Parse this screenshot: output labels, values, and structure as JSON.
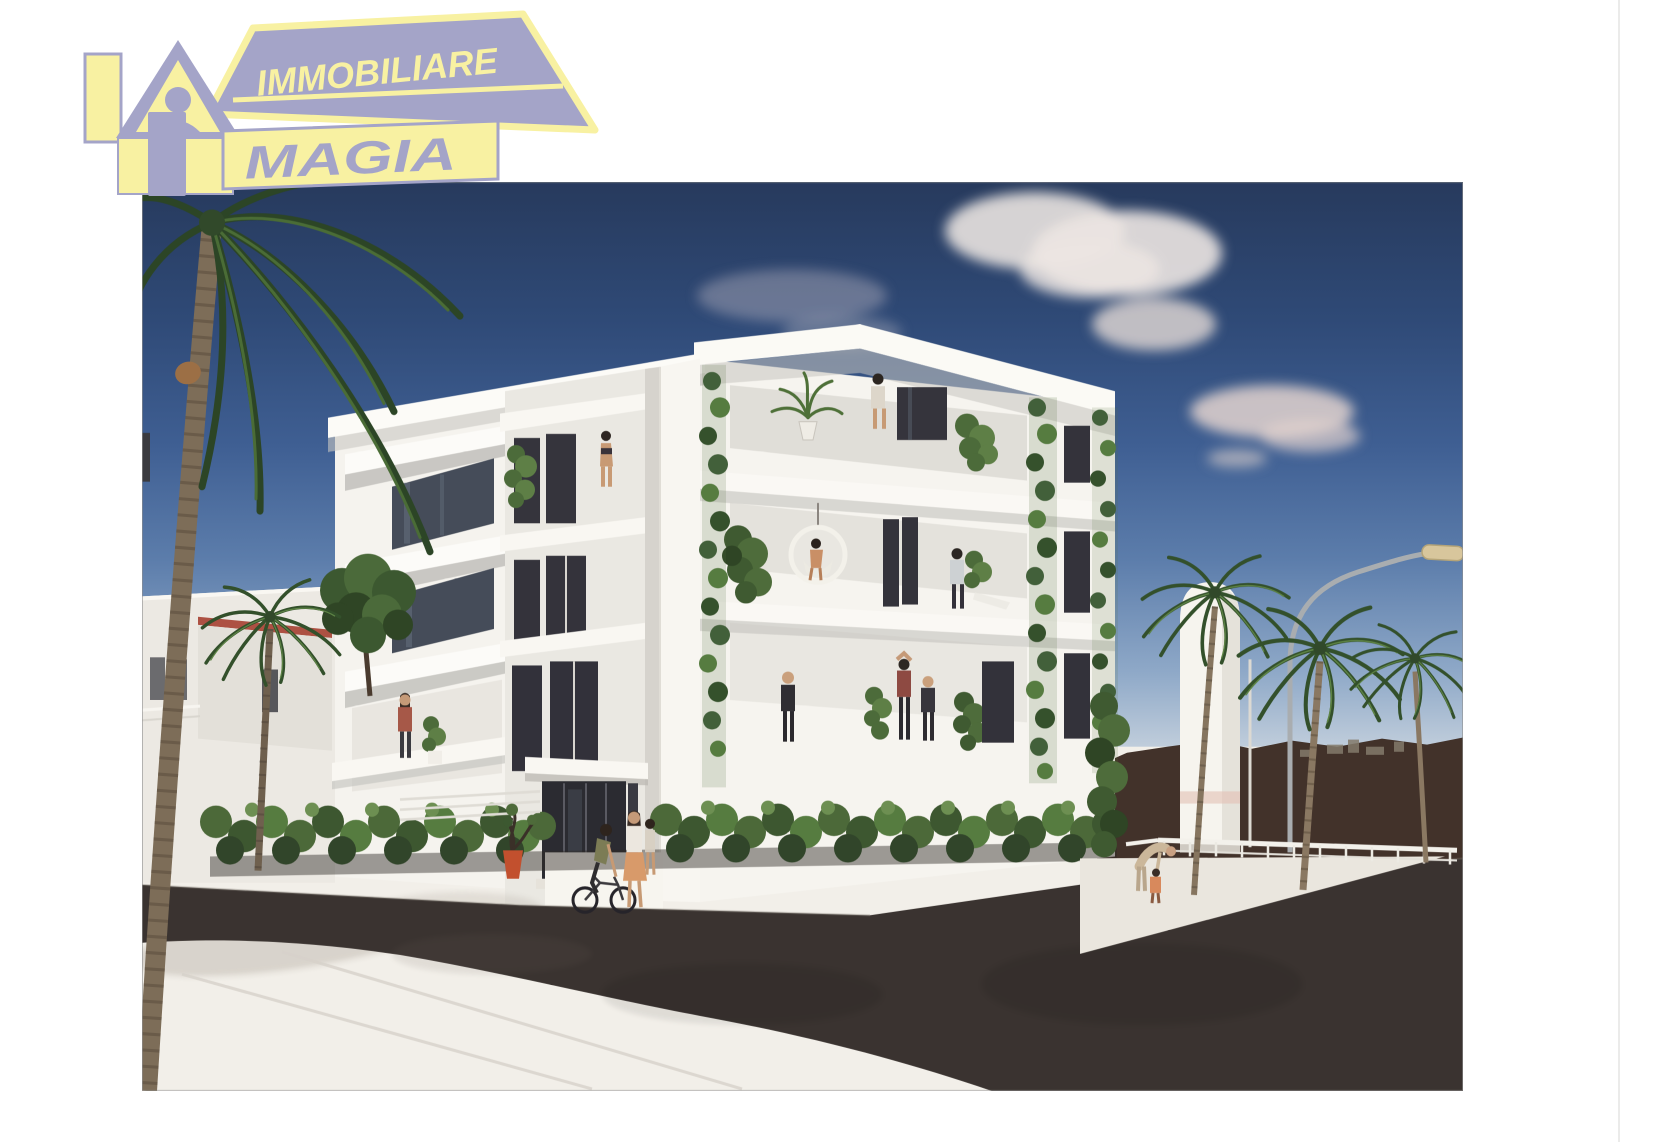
{
  "page": {
    "background": "#ffffff"
  },
  "logo": {
    "title": "Immobiliare Magia",
    "line1": "IMMOBILIARE",
    "line2": "MAGIA",
    "colors": {
      "yellow": "#f8f1a2",
      "lavender": "#a4a4c8"
    }
  },
  "scene": {
    "type": "architectural-rendering-photo",
    "palette": {
      "sky_top": "#273a5d",
      "sky_horizon": "#c9d4df",
      "building": "#f5f3ee",
      "vegetation": "#4c6939",
      "road": "#3a3330",
      "hills": "#42322a",
      "sidewalk": "#f2efe9"
    }
  }
}
